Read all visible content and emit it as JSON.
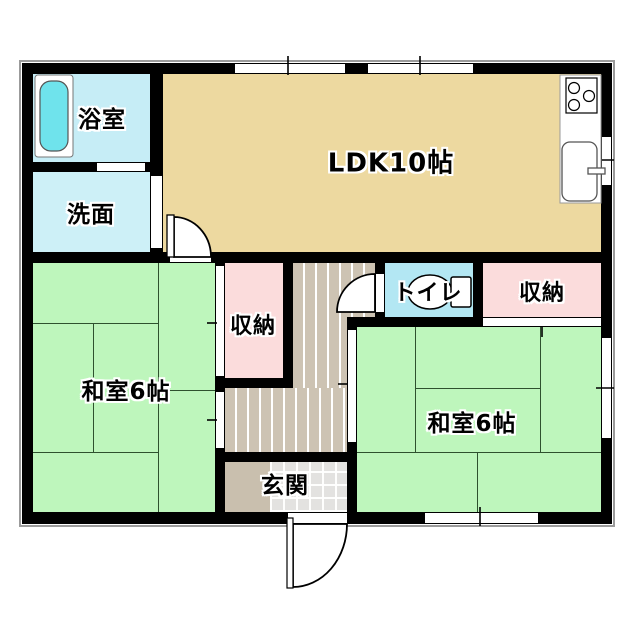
{
  "floorplan": {
    "rooms": {
      "bathroom": {
        "label": "浴室"
      },
      "washroom": {
        "label": "洗面"
      },
      "ldk": {
        "label": "LDK10帖"
      },
      "closet_center": {
        "label": "収納"
      },
      "toilet": {
        "label": "トイレ"
      },
      "closet_right": {
        "label": "収納"
      },
      "tatami_left": {
        "label": "和室6帖"
      },
      "tatami_right": {
        "label": "和室6帖"
      },
      "entrance": {
        "label": "玄関"
      }
    },
    "colors": {
      "wall": "#000000",
      "ldk_floor": "#edd9a0",
      "tatami_floor": "#bef6bc",
      "closet_floor": "#fbdcdc",
      "bathroom_floor": "#c6edf6",
      "washroom_floor": "#cdf0f7",
      "toilet_floor": "#b3e7f3",
      "bathtub": "#6fe3ec",
      "wood_hall_floor": "#cdc3b3",
      "entrance_tile": "#e3e2e0"
    }
  }
}
